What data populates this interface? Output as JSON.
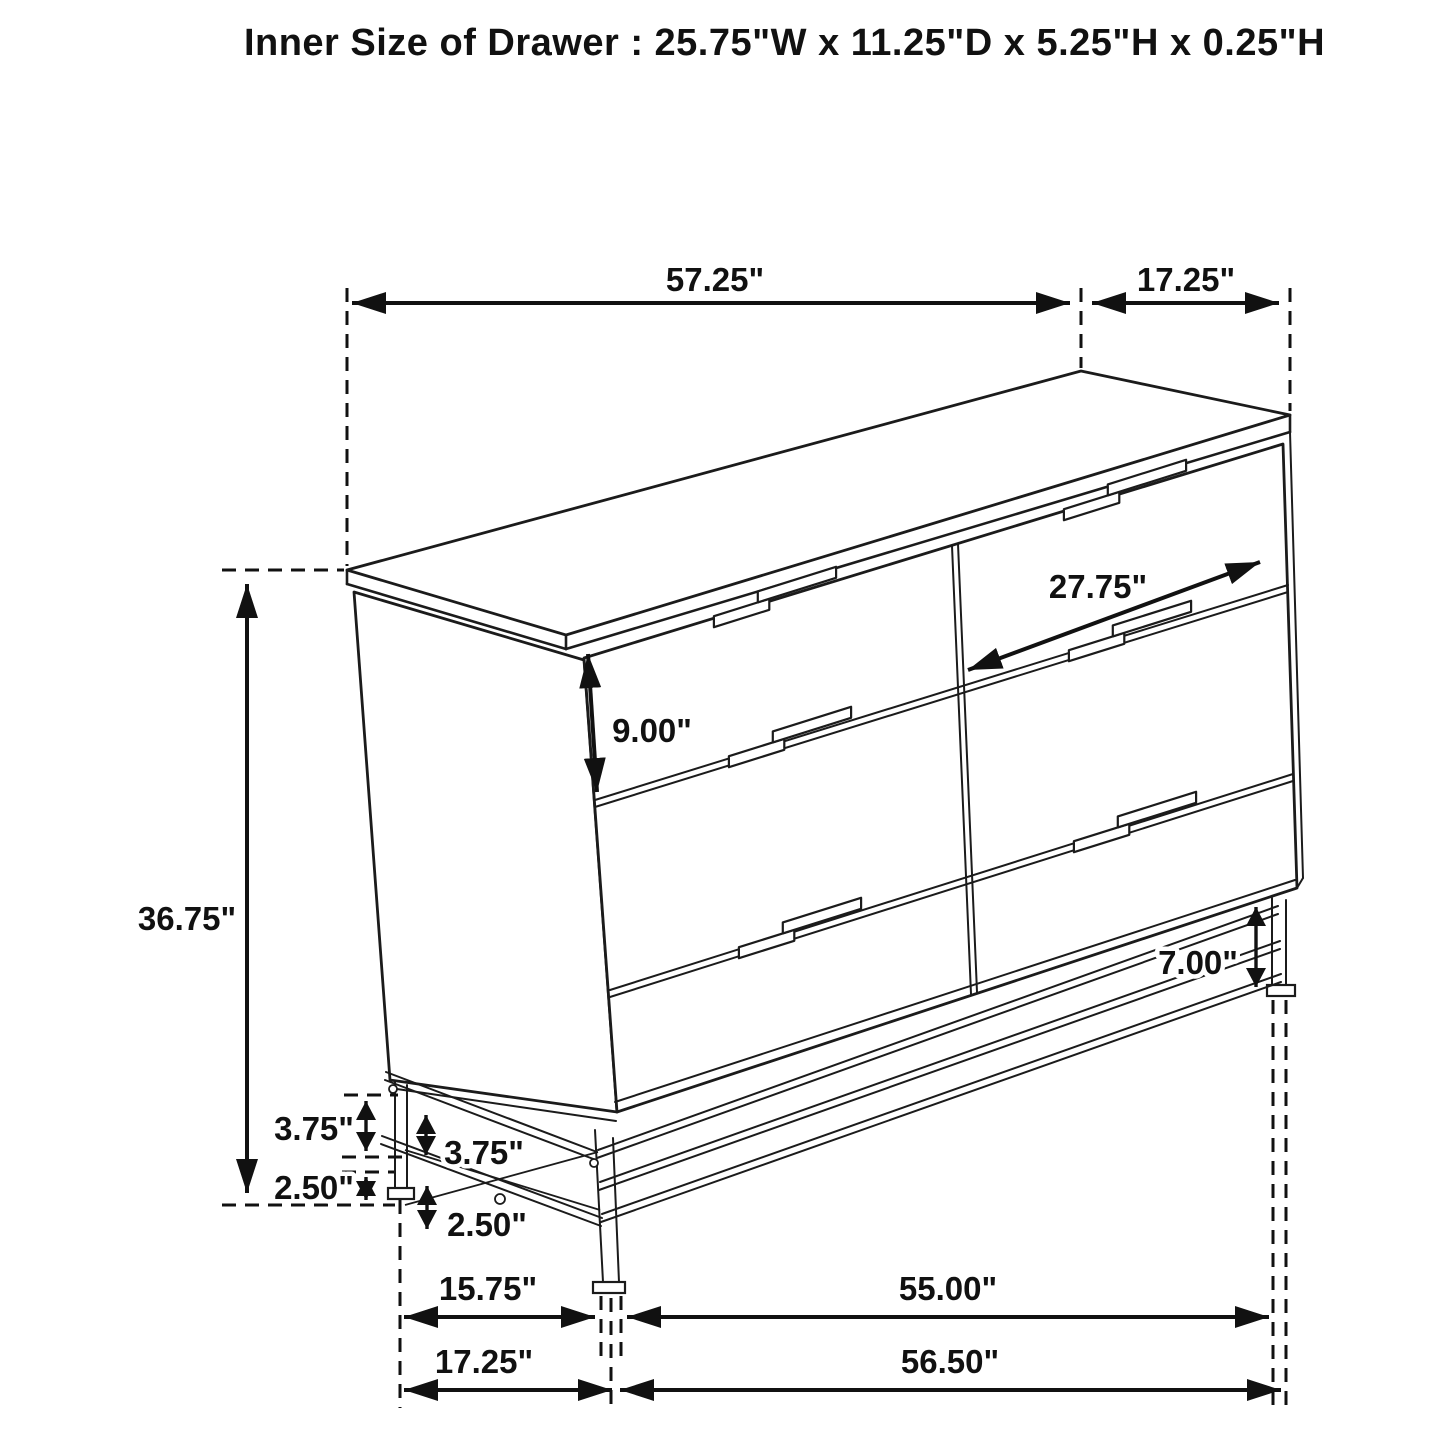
{
  "title": "Inner Size of Drawer : 25.75\"W x 11.25\"D x 5.25\"H x 0.25\"H",
  "dimensions": {
    "top_width": "57.25\"",
    "top_depth": "17.25\"",
    "drawer_width": "27.75\"",
    "top_drawer_front_height": "9.00\"",
    "overall_height": "36.75\"",
    "base_leg_height": "7.00\"",
    "base_upper_gap_left": "3.75\"",
    "base_upper_gap_side": "3.75\"",
    "base_lower_gap_left": "2.50\"",
    "base_lower_gap_side": "2.50\"",
    "foot_span_depth_inner": "15.75\"",
    "foot_span_width_inner": "55.00\"",
    "foot_span_depth_outer": "17.25\"",
    "foot_span_width_outer": "56.50\""
  },
  "colors": {
    "line": "#1b1b1b",
    "background": "#ffffff"
  }
}
